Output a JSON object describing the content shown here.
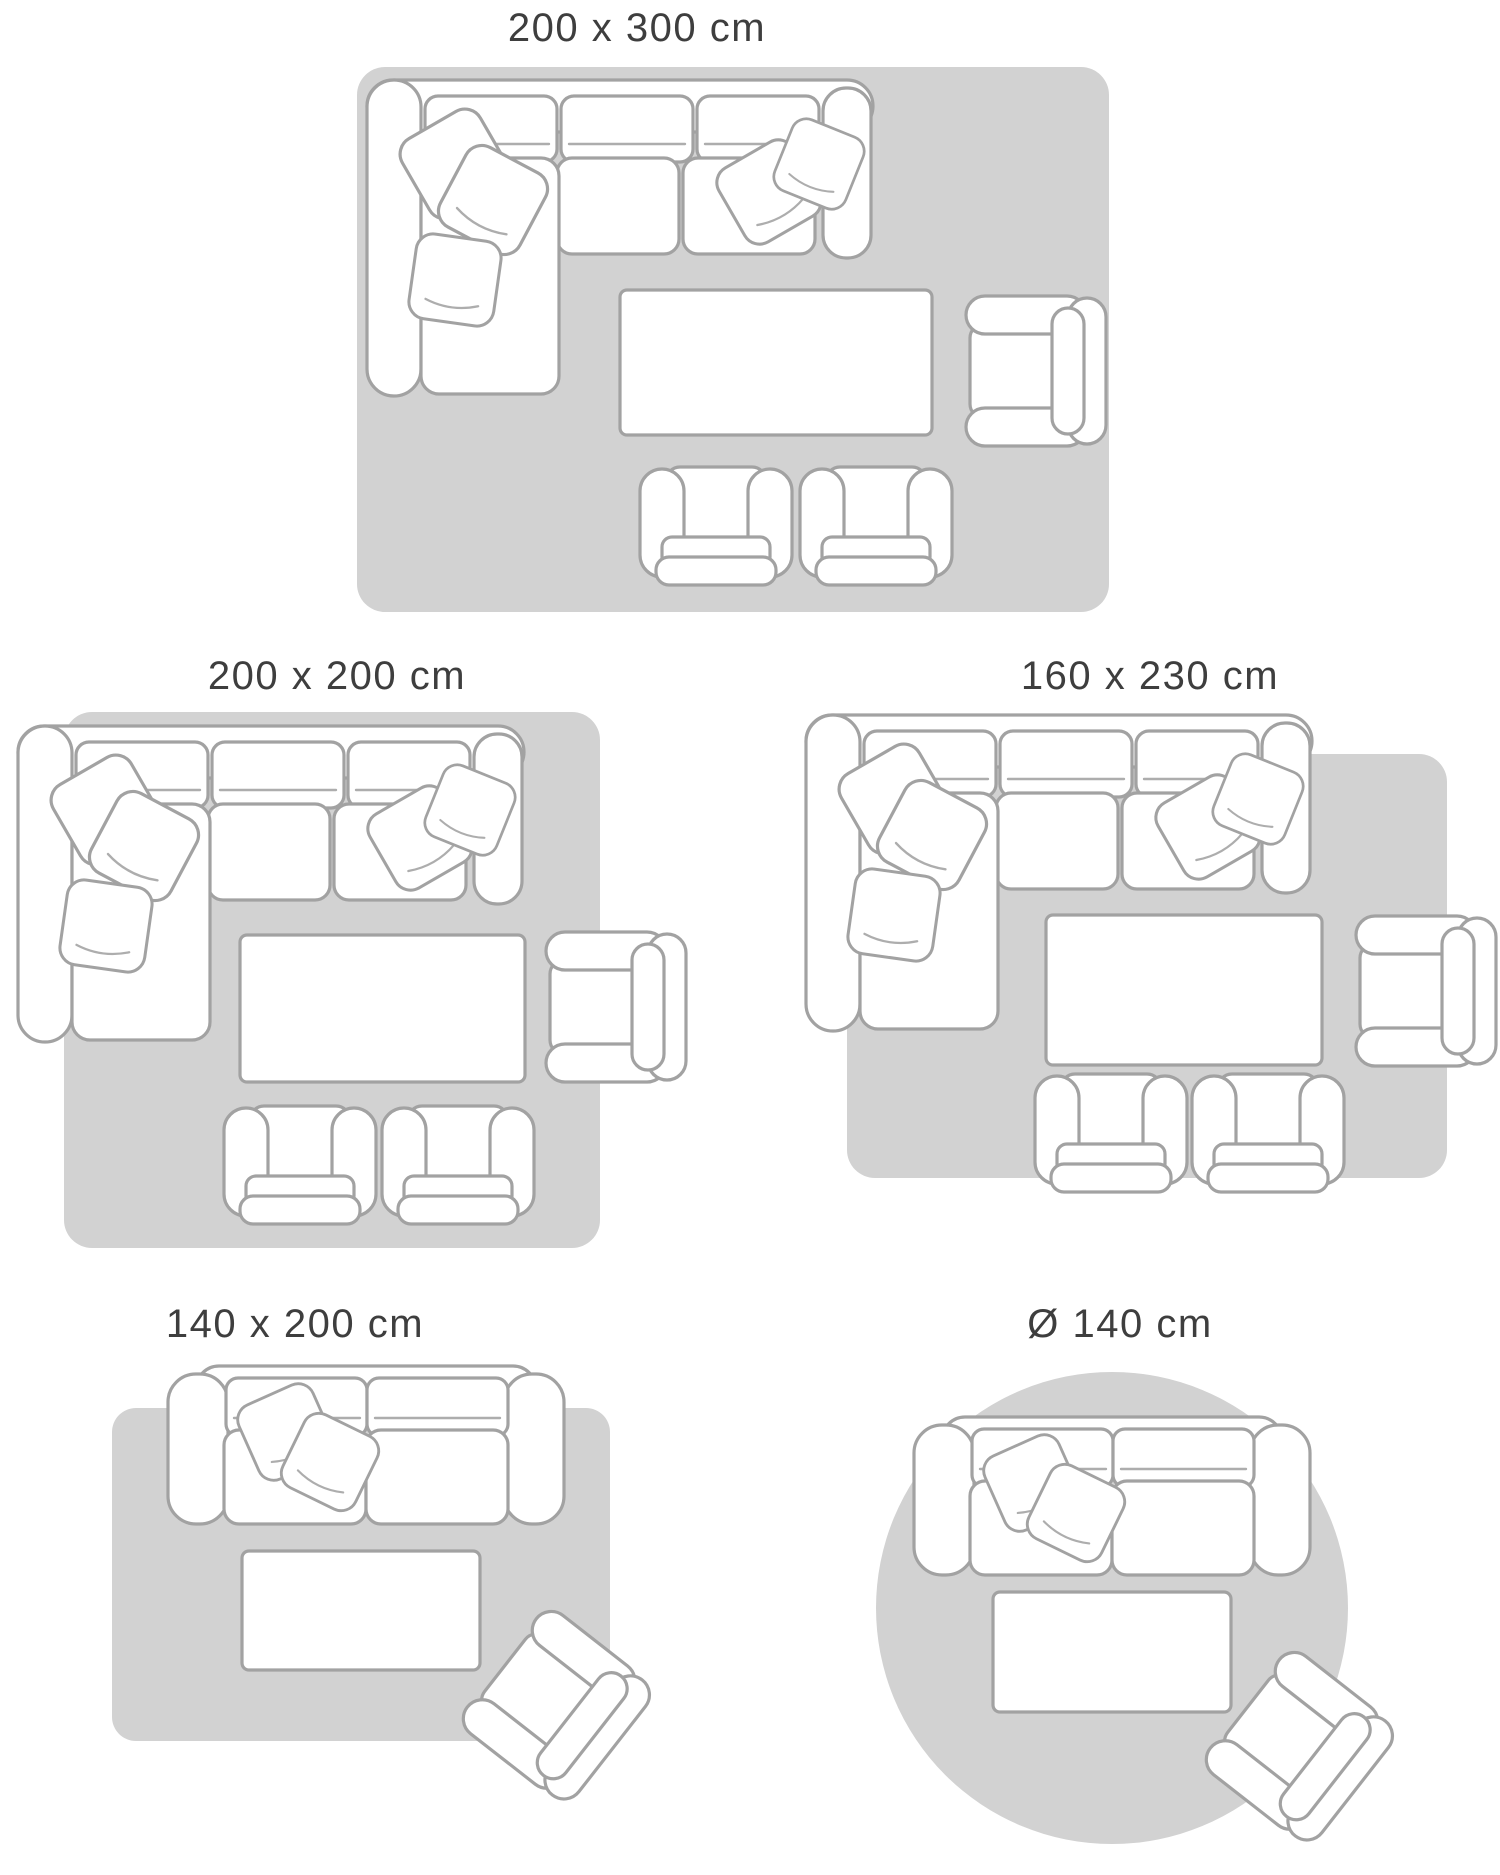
{
  "colors": {
    "rug": "#d2d2d2",
    "furniture_fill": "#ffffff",
    "furniture_outline": "#a2a2a2",
    "label_text": "#3e3e3e",
    "background": "#ffffff"
  },
  "diagrams": [
    {
      "id": "200x300",
      "label": "200 x 300 cm",
      "rug_shape": "rectangle",
      "furniture": [
        "corner-sofa",
        "coffee-table",
        "armchair",
        "small-armchair",
        "small-armchair"
      ]
    },
    {
      "id": "200x200",
      "label": "200 x 200 cm",
      "rug_shape": "rectangle",
      "furniture": [
        "corner-sofa",
        "coffee-table",
        "armchair",
        "small-armchair",
        "small-armchair"
      ]
    },
    {
      "id": "160x230",
      "label": "160 x 230 cm",
      "rug_shape": "rectangle",
      "furniture": [
        "corner-sofa",
        "coffee-table",
        "armchair",
        "small-armchair",
        "small-armchair"
      ]
    },
    {
      "id": "140x200",
      "label": "140 x 200 cm",
      "rug_shape": "rectangle",
      "furniture": [
        "two-seat-sofa",
        "coffee-table",
        "rotated-armchair"
      ]
    },
    {
      "id": "round-140",
      "label": "Ø 140 cm",
      "rug_shape": "circle",
      "furniture": [
        "two-seat-sofa",
        "coffee-table",
        "rotated-armchair"
      ]
    }
  ]
}
